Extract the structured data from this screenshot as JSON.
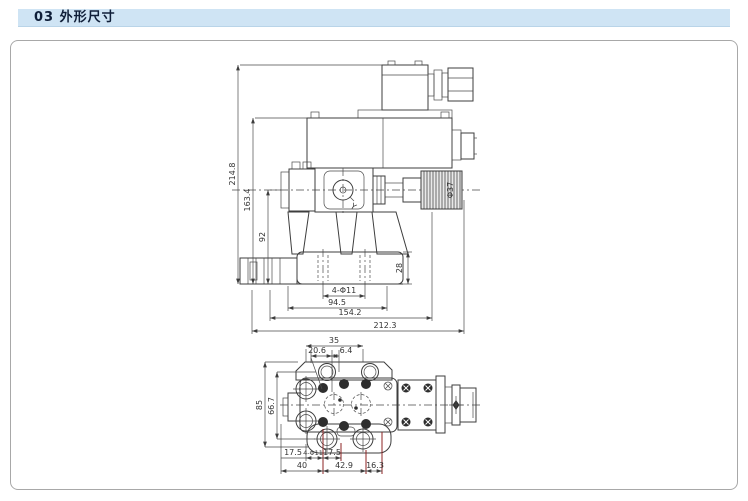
{
  "header": {
    "title": "03 外形尺寸"
  },
  "front_view": {
    "label_y": "Y",
    "dim_overall_height": "214.8",
    "dim_pilot_height": "163.4",
    "dim_centerline_height": "92",
    "dim_base_height": "28",
    "dim_mounting_holes": "4-Φ11",
    "dim_width_inner": "94.5",
    "dim_width_mid": "154.2",
    "dim_width_overall": "212.3",
    "dim_knob_diameter": "Φ37"
  },
  "top_view": {
    "dim_top_width": "35",
    "dim_top_offset_a": "20.6",
    "dim_top_offset_b": "6.4",
    "dim_left_height": "85",
    "dim_left_inner": "66.7",
    "dim_bottom_a": "17.5",
    "dim_bottom_holes": "4-Φ11",
    "dim_bottom_b": "17.5",
    "dim_bottom_c": "40",
    "dim_bottom_d": "42.9",
    "dim_bottom_e": "16.3"
  },
  "colors": {
    "accent_bar": "#cfe4f4",
    "header_text": "#0f1e38",
    "drawing_line": "#3d3d3d",
    "red_extension_line": "#8e2323",
    "panel_border": "#a8a8a8"
  }
}
